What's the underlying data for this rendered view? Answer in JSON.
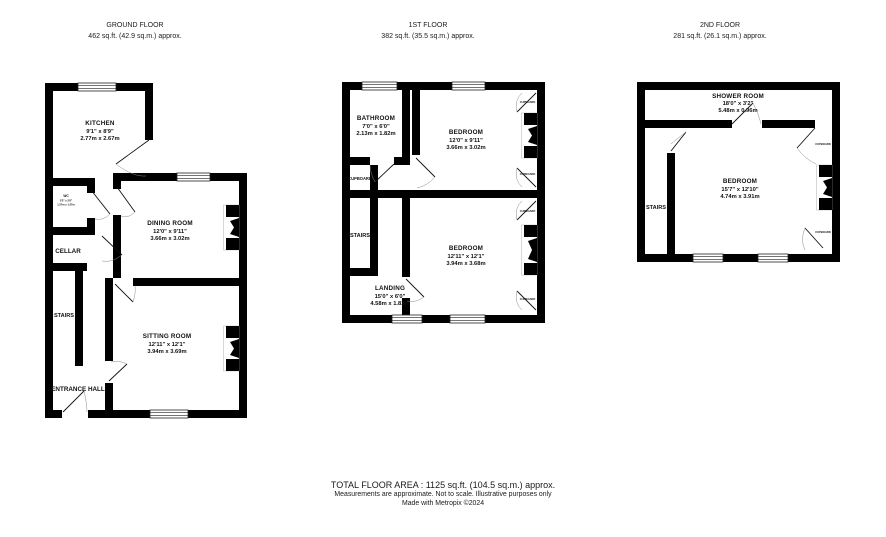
{
  "floors": [
    {
      "title": "GROUND FLOOR",
      "area": "462 sq.ft. (42.9 sq.m.) approx.",
      "rooms": {
        "kitchen": {
          "name": "KITCHEN",
          "imperial": "9'1\" x 8'9\"",
          "metric": "2.77m x 2.67m"
        },
        "wc": {
          "name": "WC",
          "imperial": "5'2\" x 3'6\"",
          "metric": "1.57m x 1.07m"
        },
        "dining_room": {
          "name": "DINING ROOM",
          "imperial": "12'0\" x 9'11\"",
          "metric": "3.66m x 3.02m"
        },
        "cellar": {
          "name": "CELLAR"
        },
        "stairs": {
          "name": "STAIRS"
        },
        "entrance_hall": {
          "name": "ENTRANCE HALL"
        },
        "sitting_room": {
          "name": "SITTING ROOM",
          "imperial": "12'11\" x 12'1\"",
          "metric": "3.94m x 3.69m"
        }
      }
    },
    {
      "title": "1ST FLOOR",
      "area": "382 sq.ft. (35.5 sq.m.) approx.",
      "rooms": {
        "bathroom": {
          "name": "BATHROOM",
          "imperial": "7'0\" x 6'0\"",
          "metric": "2.13m x 1.82m"
        },
        "bedroom_front": {
          "name": "BEDROOM",
          "imperial": "12'0\" x 9'11\"",
          "metric": "3.66m x 3.02m"
        },
        "bedroom_back": {
          "name": "BEDROOM",
          "imperial": "12'11\" x 12'1\"",
          "metric": "3.94m x 3.68m"
        },
        "landing": {
          "name": "LANDING",
          "imperial": "15'0\" x 6'0\"",
          "metric": "4.58m x 1.82m"
        },
        "stairs": {
          "name": "STAIRS"
        },
        "cupboard_left": {
          "name": "CUPBOARD"
        },
        "cupboards_right": [
          "CUPBOARD",
          "CUPBOARD",
          "CUPBOARD",
          "CUPBOARD"
        ]
      }
    },
    {
      "title": "2ND FLOOR",
      "area": "281 sq.ft. (26.1 sq.m.) approx.",
      "rooms": {
        "shower_room": {
          "name": "SHOWER ROOM",
          "imperial": "18'0\" x 3'2\"",
          "metric": "5.48m x 0.96m"
        },
        "bedroom": {
          "name": "BEDROOM",
          "imperial": "15'7\" x 12'10\"",
          "metric": "4.74m x 3.91m"
        },
        "stairs": {
          "name": "STAIRS"
        },
        "cupboards_right": [
          "CUPBOARD",
          "CUPBOARD"
        ]
      }
    }
  ],
  "footer": {
    "total": "TOTAL FLOOR AREA : 1125 sq.ft. (104.5 sq.m.) approx.",
    "disclaimer": "Measurements are approximate.  Not to scale.  Illustrative purposes only",
    "credit": "Made with Metropix ©2024"
  },
  "colors": {
    "wall": "#000000",
    "text": "#111111",
    "door_arc": "#8a8a8a",
    "background": "#ffffff"
  }
}
